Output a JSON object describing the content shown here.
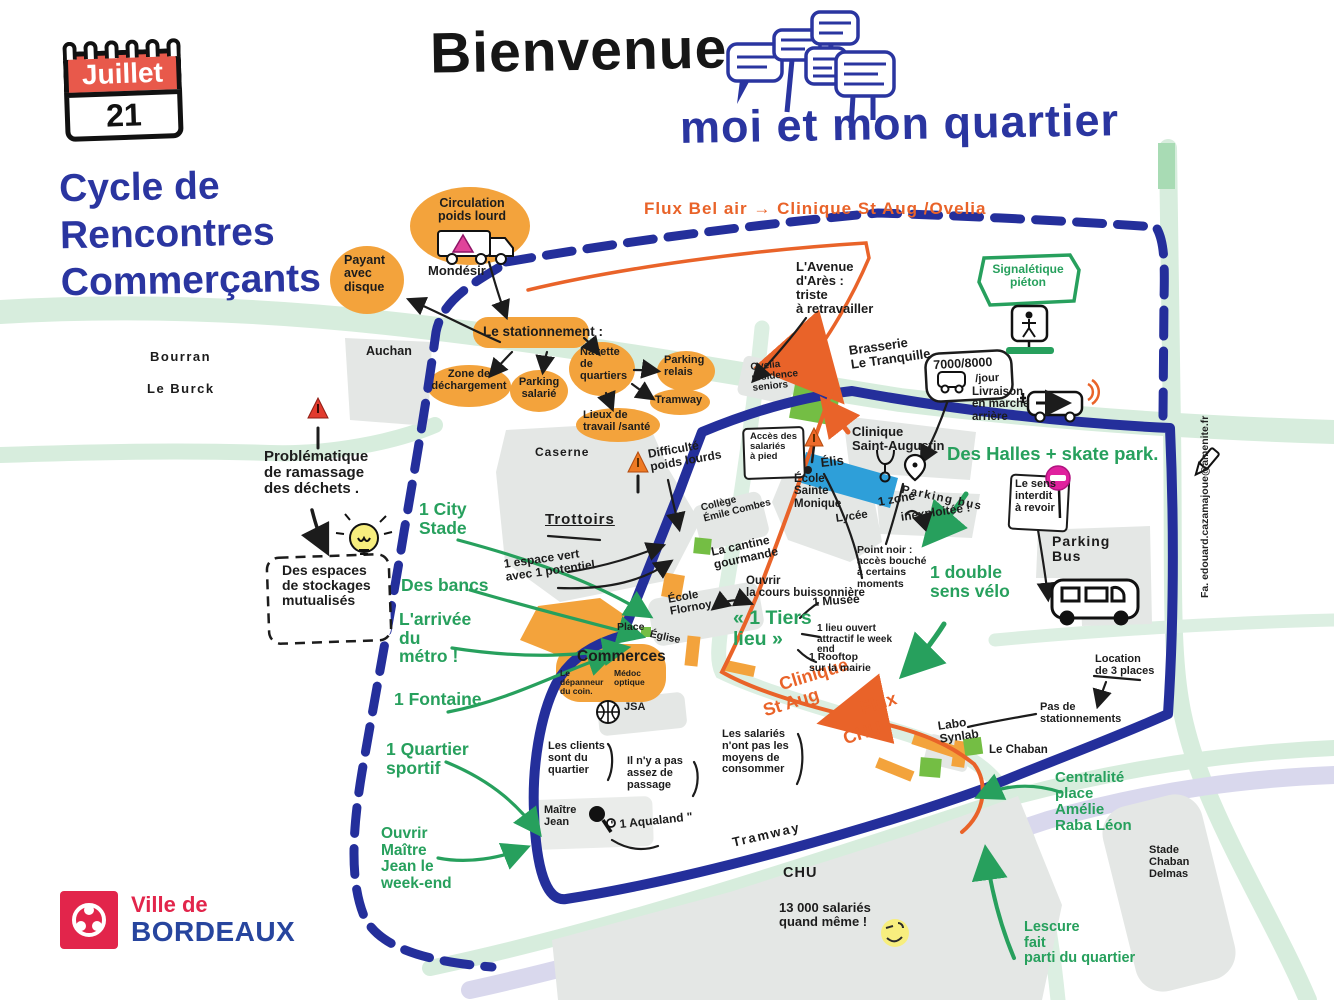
{
  "page": {
    "bienvenue": "Bienvenue",
    "quartier_title": "moi et mon quartier"
  },
  "calendar": {
    "month": "Juillet",
    "day": "21"
  },
  "series": {
    "l1": "Cycle de",
    "l2": "Rencontres",
    "l3": "Commerçants"
  },
  "logo": {
    "prefix": "Ville de",
    "city": "BORDEAUX"
  },
  "credit": {
    "text": "Fa. edouard.cazamajoue@amenite.fr"
  },
  "colors": {
    "blue": "#2A35A0",
    "orange_fill": "#F3A33C",
    "orange_flux": "#E96329",
    "green": "#27A05D",
    "red_calendar": "#E8594B",
    "magenta": "#E0219E",
    "grey_block": "#E4E7E5",
    "road_green": "#D7EDDD",
    "tram_lavender": "#D9D8ED",
    "yellow": "#F7EE7E",
    "blue_shape": "#2E9FD9",
    "green_shape": "#74BE44",
    "brand_red": "#E2254B",
    "brand_blue": "#27459E"
  },
  "labels": [
    {
      "n": "flux-bel-air-label",
      "t": "Flux Bel air → Clinique St Aug /Ovelia",
      "x": 644,
      "y": 200,
      "s": 17,
      "c": "o",
      "fw": 800,
      "ls": 1
    },
    {
      "n": "mondesir-label",
      "t": "Mondésir",
      "x": 428,
      "y": 264,
      "s": 13,
      "c": "k"
    },
    {
      "n": "bourran-label",
      "t": "Bourran",
      "x": 150,
      "y": 350,
      "s": 13,
      "c": "k",
      "ls": 1.5
    },
    {
      "n": "le-burck-label",
      "t": "Le Burck",
      "x": 147,
      "y": 382,
      "s": 13,
      "c": "k",
      "ls": 1.5
    },
    {
      "n": "auchan-label",
      "t": "Auchan",
      "x": 366,
      "y": 345,
      "s": 12.5,
      "c": "k"
    },
    {
      "n": "circulation-poids-lourd-label",
      "t": "Circulation\npoids lourd",
      "x": 436,
      "y": 197,
      "s": 12.5,
      "c": "k",
      "ta": "c",
      "w": 72
    },
    {
      "n": "payant-avec-disque-label",
      "t": "Payant\navec\ndisque",
      "x": 344,
      "y": 254,
      "s": 12.5,
      "c": "k"
    },
    {
      "n": "le-stationnement-label",
      "t": "Le stationnement :",
      "x": 483,
      "y": 325,
      "s": 13.5,
      "c": "k"
    },
    {
      "n": "zone-dechargement-label",
      "t": "Zone de\ndéchargement",
      "x": 430,
      "y": 369,
      "s": 11,
      "c": "k",
      "ta": "c",
      "w": 78
    },
    {
      "n": "parking-salarie-label",
      "t": "Parking\nsalarié",
      "x": 517,
      "y": 377,
      "s": 11,
      "c": "k",
      "ta": "c",
      "w": 44
    },
    {
      "n": "navette-quartiers-label",
      "t": "Navette\nde\nquartiers",
      "x": 580,
      "y": 347,
      "s": 11,
      "c": "k"
    },
    {
      "n": "parking-relais-label",
      "t": "Parking\nrelais",
      "x": 664,
      "y": 355,
      "s": 11,
      "c": "k"
    },
    {
      "n": "tramway-blob-label",
      "t": "Tramway",
      "x": 655,
      "y": 395,
      "s": 11,
      "c": "k"
    },
    {
      "n": "lieux-travail-sante-label",
      "t": "Lieux de\ntravail /santé",
      "x": 583,
      "y": 410,
      "s": 11,
      "c": "k"
    },
    {
      "n": "avenue-ares-label",
      "t": "L'Avenue\nd'Arès :\ntriste\nà retravailler",
      "x": 796,
      "y": 260,
      "s": 13,
      "c": "k"
    },
    {
      "n": "signaletique-pieton-label",
      "t": "Signalétique\npiéton",
      "x": 990,
      "y": 263,
      "s": 12,
      "c": "g",
      "ta": "c",
      "w": 76
    },
    {
      "n": "brasserie-label",
      "t": "Brasserie\nLe Tranquille",
      "x": 848,
      "y": 344,
      "s": 13,
      "c": "k",
      "r": -8
    },
    {
      "n": "n7000-label",
      "t": "7000/8000",
      "x": 933,
      "y": 359,
      "s": 12.5,
      "c": "k",
      "r": -3
    },
    {
      "n": "jour-label",
      "t": "/jour",
      "x": 975,
      "y": 374,
      "s": 11,
      "c": "k",
      "r": -3
    },
    {
      "n": "livraison-label",
      "t": "Livraison\nen marche\narrière",
      "x": 972,
      "y": 386,
      "s": 11.5,
      "c": "k"
    },
    {
      "n": "ovelia-label",
      "t": "Ovelia\nrésidence\nseniors",
      "x": 750,
      "y": 363,
      "s": 10,
      "c": "k",
      "r": -6
    },
    {
      "n": "acces-salaries-label",
      "t": "Accès des\nsalariés\nà pied",
      "x": 750,
      "y": 432,
      "s": 9.5,
      "c": "k"
    },
    {
      "n": "elis-label",
      "t": "Élis",
      "x": 820,
      "y": 456,
      "s": 13,
      "c": "k",
      "r": -6
    },
    {
      "n": "ecole-sainte-monique-label",
      "t": "École\nSainte\nMonique",
      "x": 794,
      "y": 473,
      "s": 11.5,
      "c": "k"
    },
    {
      "n": "lycee-label",
      "t": "Lycée",
      "x": 835,
      "y": 513,
      "s": 11.5,
      "c": "k",
      "r": -8
    },
    {
      "n": "clinique-saint-augustin-label",
      "t": "Clinique\nSaint-Augustin",
      "x": 852,
      "y": 425,
      "s": 13,
      "c": "k"
    },
    {
      "n": "parking-bus-mid-label",
      "t": "Parking bus",
      "x": 903,
      "y": 484,
      "s": 11.5,
      "c": "k",
      "r": 12,
      "ls": 1.5
    },
    {
      "n": "zone-inexploitee-label",
      "t": "1 zone",
      "x": 877,
      "y": 496,
      "s": 12,
      "c": "k",
      "r": -10
    },
    {
      "n": "inexploitee-label",
      "t": "inexploitée !",
      "x": 900,
      "y": 511,
      "s": 12,
      "c": "k",
      "r": -8
    },
    {
      "n": "des-halles-label",
      "t": "Des Halles + skate park.",
      "x": 947,
      "y": 444,
      "s": 18.5,
      "c": "g",
      "fw": 800
    },
    {
      "n": "sens-interdit-label",
      "t": "Le sens\ninterdit\nà revoir",
      "x": 1015,
      "y": 479,
      "s": 11,
      "c": "k"
    },
    {
      "n": "parking-bus-right-label",
      "t": "Parking\nBus",
      "x": 1052,
      "y": 534,
      "s": 14,
      "c": "k",
      "ls": 1
    },
    {
      "n": "point-noir-label",
      "t": "Point noir :\naccès bouché\nà certains\nmoments",
      "x": 857,
      "y": 545,
      "s": 10.5,
      "c": "k"
    },
    {
      "n": "double-sens-velo-label",
      "t": "1 double\nsens vélo",
      "x": 930,
      "y": 563,
      "s": 17.5,
      "c": "g",
      "fw": 800
    },
    {
      "n": "caserne-label",
      "t": "Caserne",
      "x": 535,
      "y": 446,
      "s": 12,
      "c": "k",
      "ls": 1
    },
    {
      "n": "trottoirs-label",
      "t": "Trottoirs",
      "x": 545,
      "y": 512,
      "s": 15,
      "c": "k",
      "ls": 1,
      "u": 1
    },
    {
      "n": "difficulte-poids-lourds-label",
      "t": "Difficulté\npoids lourds",
      "x": 647,
      "y": 448,
      "s": 12,
      "c": "k",
      "r": -10
    },
    {
      "n": "college-emile-combes-label",
      "t": "Collège\nÉmile Combes",
      "x": 700,
      "y": 504,
      "s": 10,
      "c": "k",
      "r": -14
    },
    {
      "n": "cantine-gourmande-label",
      "t": "La cantine\ngourmande",
      "x": 710,
      "y": 546,
      "s": 12,
      "c": "k",
      "r": -12
    },
    {
      "n": "ouvrir-cours-buissonniere-label",
      "t": "Ouvrir\nla cours buissonnière",
      "x": 746,
      "y": 575,
      "s": 11.5,
      "c": "k"
    },
    {
      "n": "ecole-flornoy-label",
      "t": "École\nFlornoy",
      "x": 667,
      "y": 594,
      "s": 11.5,
      "c": "k",
      "r": -10
    },
    {
      "n": "place-label",
      "t": "Place",
      "x": 617,
      "y": 622,
      "s": 10.5,
      "c": "k"
    },
    {
      "n": "eglise-label",
      "t": "Église",
      "x": 651,
      "y": 629,
      "s": 10.5,
      "c": "k",
      "r": 12
    },
    {
      "n": "commerces-label",
      "t": "Commerces",
      "x": 577,
      "y": 649,
      "s": 15.5,
      "c": "k",
      "fw": 800
    },
    {
      "n": "depanneur-label",
      "t": "Le\ndépanneur\ndu coin.",
      "x": 560,
      "y": 669,
      "s": 8.5,
      "c": "k"
    },
    {
      "n": "medoc-optique-label",
      "t": "Médoc\noptique",
      "x": 614,
      "y": 669,
      "s": 8.5,
      "c": "k"
    },
    {
      "n": "jsa-label",
      "t": "JSA",
      "x": 624,
      "y": 702,
      "s": 11,
      "c": "k"
    },
    {
      "n": "les-clients-label",
      "t": "Les clients\nsont du\nquartier",
      "x": 548,
      "y": 741,
      "s": 11,
      "c": "k"
    },
    {
      "n": "pas-assez-passage-label",
      "t": "Il n'y a pas\nassez de\npassage",
      "x": 627,
      "y": 756,
      "s": 11,
      "c": "k"
    },
    {
      "n": "salaries-consommer-label",
      "t": "Les salariés\nn'ont pas les\nmoyens de\nconsommer",
      "x": 722,
      "y": 729,
      "s": 11,
      "c": "k"
    },
    {
      "n": "maitre-jean-label",
      "t": "Maître\nJean",
      "x": 544,
      "y": 805,
      "s": 11,
      "c": "k"
    },
    {
      "n": "aqualand-label",
      "t": "\" 1 Aqualand \"",
      "x": 610,
      "y": 819,
      "s": 12,
      "c": "k",
      "r": -6
    },
    {
      "n": "flux-clinique-label",
      "t": "Clinique",
      "x": 777,
      "y": 676,
      "s": 18,
      "c": "o",
      "fw": 800,
      "r": -17
    },
    {
      "n": "flux-staug-label",
      "t": "St Aug",
      "x": 761,
      "y": 702,
      "s": 18,
      "c": "o",
      "fw": 800,
      "r": -17
    },
    {
      "n": "flux-flux-label",
      "t": "Flux",
      "x": 858,
      "y": 700,
      "s": 18,
      "c": "o",
      "fw": 800,
      "r": -17
    },
    {
      "n": "flux-chu-label",
      "t": "CHU",
      "x": 841,
      "y": 730,
      "s": 18,
      "c": "o",
      "fw": 800,
      "r": -17
    },
    {
      "n": "labo-synlab-label",
      "t": "Labo\nSynlab",
      "x": 937,
      "y": 720,
      "s": 12,
      "c": "k",
      "r": -8
    },
    {
      "n": "le-chaban-label",
      "t": "Le Chaban",
      "x": 989,
      "y": 744,
      "s": 11.5,
      "c": "k"
    },
    {
      "n": "pas-stationnements-label",
      "t": "Pas de\nstationnements",
      "x": 1040,
      "y": 702,
      "s": 11,
      "c": "k"
    },
    {
      "n": "location-3-places-label",
      "t": "Location\nde 3 places",
      "x": 1095,
      "y": 654,
      "s": 11,
      "c": "k"
    },
    {
      "n": "tramway-track-label",
      "t": "Tramway",
      "x": 731,
      "y": 836,
      "s": 13,
      "c": "k",
      "r": -13,
      "ls": 2
    },
    {
      "n": "chu-area-label",
      "t": "CHU",
      "x": 783,
      "y": 866,
      "s": 14.5,
      "c": "k",
      "ls": 1
    },
    {
      "n": "salaries-13000-label",
      "t": "13 000 salariés\nquand même !",
      "x": 779,
      "y": 901,
      "s": 13,
      "c": "k"
    },
    {
      "n": "centralite-label",
      "t": "Centralité\nplace\nAmélie\nRaba Léon",
      "x": 1055,
      "y": 770,
      "s": 15,
      "c": "g",
      "fw": 800
    },
    {
      "n": "stade-chaban-delmas-label",
      "t": "Stade\nChaban\nDelmas",
      "x": 1149,
      "y": 845,
      "s": 11,
      "c": "k"
    },
    {
      "n": "lescure-label",
      "t": "Lescure\nfait\nparti du quartier",
      "x": 1024,
      "y": 920,
      "s": 14.5,
      "c": "g",
      "fw": 800
    },
    {
      "n": "problematique-dechets-label",
      "t": "Problématique\nde ramassage\ndes déchets .",
      "x": 264,
      "y": 449,
      "s": 15,
      "c": "k"
    },
    {
      "n": "stockages-label",
      "t": "Des espaces\nde stockages\nmutualisés",
      "x": 282,
      "y": 563,
      "s": 14,
      "c": "k"
    },
    {
      "n": "city-stade-label",
      "t": "1 City\nStade",
      "x": 419,
      "y": 500,
      "s": 17.5,
      "c": "g",
      "fw": 800
    },
    {
      "n": "des-bancs-label",
      "t": "Des bancs",
      "x": 401,
      "y": 576,
      "s": 17.5,
      "c": "g",
      "fw": 800
    },
    {
      "n": "arrivee-metro-label",
      "t": "L'arrivée\ndu\nmétro !",
      "x": 399,
      "y": 610,
      "s": 17.5,
      "c": "g",
      "fw": 800
    },
    {
      "n": "fontaine-label",
      "t": "1 Fontaine",
      "x": 394,
      "y": 690,
      "s": 17.5,
      "c": "g",
      "fw": 800
    },
    {
      "n": "quartier-sportif-label",
      "t": "1 Quartier\nsportif",
      "x": 386,
      "y": 740,
      "s": 17.5,
      "c": "g",
      "fw": 800
    },
    {
      "n": "ouvrir-maitre-jean-label",
      "t": "Ouvrir\nMaître\nJean le\nweek-end",
      "x": 381,
      "y": 826,
      "s": 15.5,
      "c": "g",
      "fw": 800
    },
    {
      "n": "espace-vert-label",
      "t": "1 espace vert\navec 1 potentiel",
      "x": 503,
      "y": 558,
      "s": 12,
      "c": "k",
      "r": -8
    },
    {
      "n": "musee-label",
      "t": "1 Musée",
      "x": 812,
      "y": 596,
      "s": 12,
      "c": "k",
      "r": -4
    },
    {
      "n": "tiers-lieu-label",
      "t": "« 1 Tiers\nlieu »",
      "x": 733,
      "y": 608,
      "s": 19.5,
      "c": "g",
      "fw": 800
    },
    {
      "n": "lieu-ouvert-label",
      "t": "1 lieu ouvert\nattractif le week\nend",
      "x": 817,
      "y": 624,
      "s": 10,
      "c": "k"
    },
    {
      "n": "rooftop-label",
      "t": "1 Rooftop\nsur la mairie",
      "x": 809,
      "y": 652,
      "s": 10.5,
      "c": "k"
    }
  ]
}
